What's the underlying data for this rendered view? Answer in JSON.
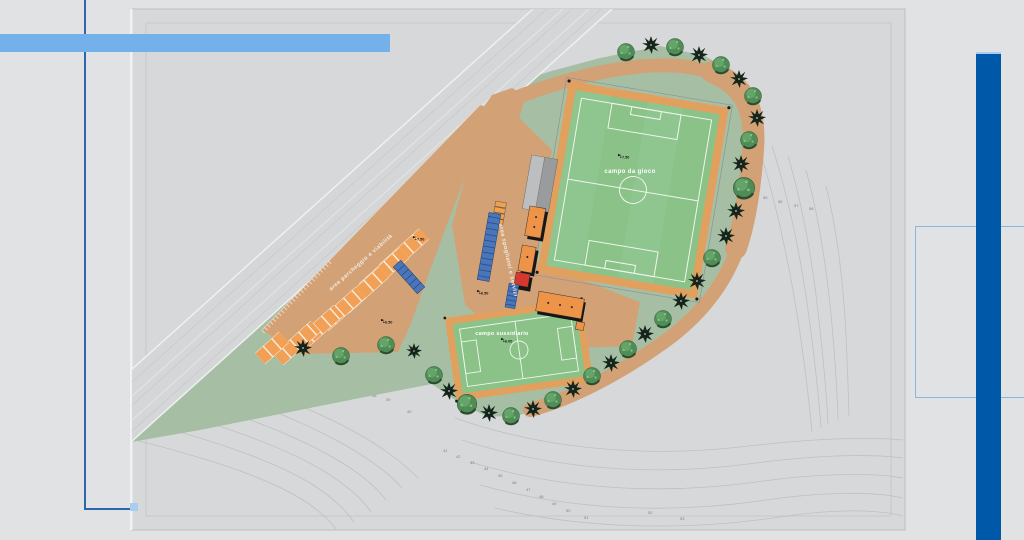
{
  "plan": {
    "labels": {
      "main_field": "campo da gioco",
      "secondary_field": "campo sussidiario",
      "parking_area": "area parcheggio e viabilità",
      "facilities_area": "area spogliatoi e servizi"
    },
    "spot_elevations": [
      {
        "x": 618,
        "y": 158,
        "label": "+7.50"
      },
      {
        "x": 413,
        "y": 240,
        "label": "+7.50"
      },
      {
        "x": 477,
        "y": 294,
        "label": "+6.50"
      },
      {
        "x": 381,
        "y": 323,
        "label": "+6.50"
      },
      {
        "x": 501,
        "y": 342,
        "label": "+6.00"
      }
    ],
    "contour_labels": [
      {
        "x": 210,
        "y": 368,
        "v": "36"
      },
      {
        "x": 372,
        "y": 397,
        "v": "38"
      },
      {
        "x": 386,
        "y": 401,
        "v": "39"
      },
      {
        "x": 407,
        "y": 413,
        "v": "40"
      },
      {
        "x": 443,
        "y": 452,
        "v": "41"
      },
      {
        "x": 456,
        "y": 458,
        "v": "42"
      },
      {
        "x": 470,
        "y": 464,
        "v": "43"
      },
      {
        "x": 484,
        "y": 470,
        "v": "44"
      },
      {
        "x": 498,
        "y": 477,
        "v": "45"
      },
      {
        "x": 512,
        "y": 484,
        "v": "46"
      },
      {
        "x": 526,
        "y": 491,
        "v": "47"
      },
      {
        "x": 539,
        "y": 498,
        "v": "48"
      },
      {
        "x": 552,
        "y": 505,
        "v": "49"
      },
      {
        "x": 566,
        "y": 512,
        "v": "50"
      },
      {
        "x": 584,
        "y": 519,
        "v": "51"
      },
      {
        "x": 648,
        "y": 514,
        "v": "52"
      },
      {
        "x": 680,
        "y": 520,
        "v": "53"
      },
      {
        "x": 763,
        "y": 199,
        "v": "55"
      },
      {
        "x": 778,
        "y": 203,
        "v": "56"
      },
      {
        "x": 794,
        "y": 207,
        "v": "57"
      },
      {
        "x": 809,
        "y": 210,
        "v": "58"
      }
    ],
    "trees": [
      {
        "t": "c",
        "x": 651,
        "y": 45
      },
      {
        "t": "g",
        "x": 626,
        "y": 52
      },
      {
        "t": "g",
        "x": 675,
        "y": 47
      },
      {
        "t": "c",
        "x": 699,
        "y": 55
      },
      {
        "t": "g",
        "x": 721,
        "y": 65
      },
      {
        "t": "c",
        "x": 739,
        "y": 79
      },
      {
        "t": "g",
        "x": 753,
        "y": 96
      },
      {
        "t": "c",
        "x": 757,
        "y": 118
      },
      {
        "t": "g",
        "x": 749,
        "y": 140
      },
      {
        "t": "c",
        "x": 741,
        "y": 164
      },
      {
        "t": "g",
        "x": 744,
        "y": 188,
        "s": 1.25
      },
      {
        "t": "c",
        "x": 736,
        "y": 211
      },
      {
        "t": "c",
        "x": 726,
        "y": 236
      },
      {
        "t": "g",
        "x": 712,
        "y": 258
      },
      {
        "t": "c",
        "x": 697,
        "y": 281
      },
      {
        "t": "c",
        "x": 681,
        "y": 301
      },
      {
        "t": "g",
        "x": 663,
        "y": 319
      },
      {
        "t": "c",
        "x": 645,
        "y": 334
      },
      {
        "t": "g",
        "x": 628,
        "y": 349
      },
      {
        "t": "c",
        "x": 611,
        "y": 363
      },
      {
        "t": "g",
        "x": 592,
        "y": 376
      },
      {
        "t": "c",
        "x": 573,
        "y": 389
      },
      {
        "t": "g",
        "x": 553,
        "y": 400
      },
      {
        "t": "c",
        "x": 533,
        "y": 409
      },
      {
        "t": "g",
        "x": 511,
        "y": 416
      },
      {
        "t": "c",
        "x": 489,
        "y": 413
      },
      {
        "t": "g",
        "x": 467,
        "y": 404,
        "s": 1.15
      },
      {
        "t": "c",
        "x": 449,
        "y": 391
      },
      {
        "t": "g",
        "x": 434,
        "y": 375
      },
      {
        "t": "c",
        "x": 414,
        "y": 351,
        "s": 0.8
      },
      {
        "t": "g",
        "x": 386,
        "y": 345
      },
      {
        "t": "g",
        "x": 341,
        "y": 356
      },
      {
        "t": "c",
        "x": 303,
        "y": 348
      }
    ],
    "parking_rows": [
      [
        383.9,
        270.1,
        424.1,
        233.9
      ],
      [
        363.9,
        289.1,
        404.1,
        252.9
      ],
      [
        343.9,
        308.1,
        384.1,
        271.9
      ],
      [
        323.4,
        325.7,
        360.6,
        292.3
      ],
      [
        301.4,
        343.7,
        338.6,
        310.3
      ],
      [
        278.4,
        359.7,
        315.6,
        326.3
      ],
      [
        260.1,
        358.7,
        283.9,
        337.3
      ]
    ],
    "colors": {
      "page_bg": "#e0e2e4",
      "panel_bg": "#d7d8da",
      "terrain_green": "#a6bfa4",
      "field_green": "#8ac288",
      "band_orange": "#e2a05f",
      "path_tan": "#d2a276",
      "stall_orange": "#f2a055",
      "building_orange": "#ee9449",
      "building_red": "#d6382d",
      "stand_blue": "#4a75b8",
      "road_gray": "#d5d6d8",
      "accent_light_blue": "#74b0ea",
      "accent_dark_blue": "#0058a8",
      "frame_blue": "#2e66ae"
    }
  }
}
